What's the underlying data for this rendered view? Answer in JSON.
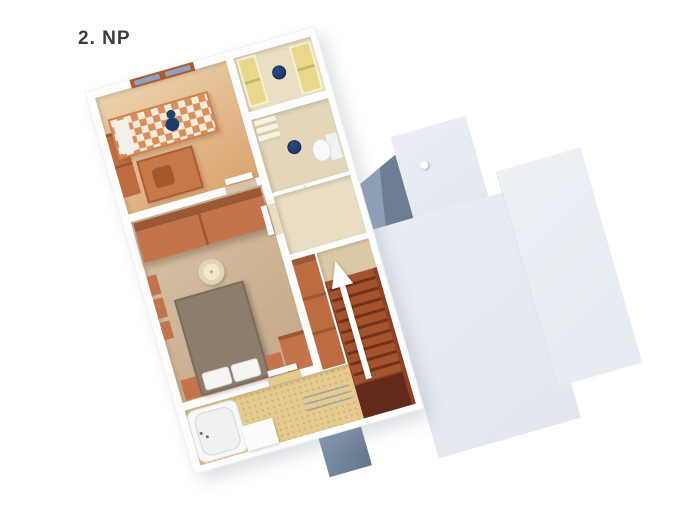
{
  "page": {
    "title_label": "2. NP",
    "background_color": "#ffffff"
  },
  "plan": {
    "view": "3d-top-down-floorplan",
    "rotation_deg": -16,
    "stair_arrow": {
      "direction": "up",
      "color": "#ffffff"
    },
    "rooms": [
      {
        "name": "children-bedroom",
        "furniture": [
          "single-bed-checkered-blanket",
          "teddy-bear",
          "pillow",
          "desk",
          "chair",
          "wardrobe",
          "window"
        ]
      },
      {
        "name": "closet-room",
        "furniture": [
          "yellow-wardrobe-left",
          "yellow-wardrobe-right",
          "navy-ceiling-lamp"
        ]
      },
      {
        "name": "upper-bathroom",
        "furniture": [
          "toilet",
          "navy-washbasin",
          "shelf-unit"
        ]
      },
      {
        "name": "master-bedroom",
        "furniture": [
          "sliding-wardrobe",
          "double-bed",
          "pillows",
          "bedside-table-left",
          "bedside-table-right",
          "ceiling-lamp",
          "wall-shelves",
          "cabinet"
        ]
      },
      {
        "name": "hallway-landing",
        "furniture": [
          "door-leaf"
        ]
      },
      {
        "name": "stair-hall",
        "furniture": [
          "tall-cabinet",
          "staircase",
          "up-arrow"
        ]
      },
      {
        "name": "lower-bathroom",
        "furniture": [
          "bathtub",
          "faucet",
          "shelf-block",
          "towel-radiator",
          "mosaic-floor"
        ]
      }
    ],
    "adjacent_roof": {
      "pieces": [
        "main-roof",
        "right-roof",
        "roof-tab",
        "shaded-notch",
        "roof-vent",
        "shadow-block"
      ]
    },
    "colors": {
      "roof": "#e8ecf2",
      "roof_shadow": "#6d7d93",
      "walls": "#fdfdfe",
      "wood_orange": "#c3744a",
      "stairs_dark": "#73301b",
      "floor_tan": "#cdb294",
      "floor_mosaic": "#e6cb90",
      "yellow_doors": "#e9d88c",
      "navy_fixture": "#1d3e72",
      "label_text": "#3d3d3d",
      "arrow": "#ffffff"
    }
  }
}
